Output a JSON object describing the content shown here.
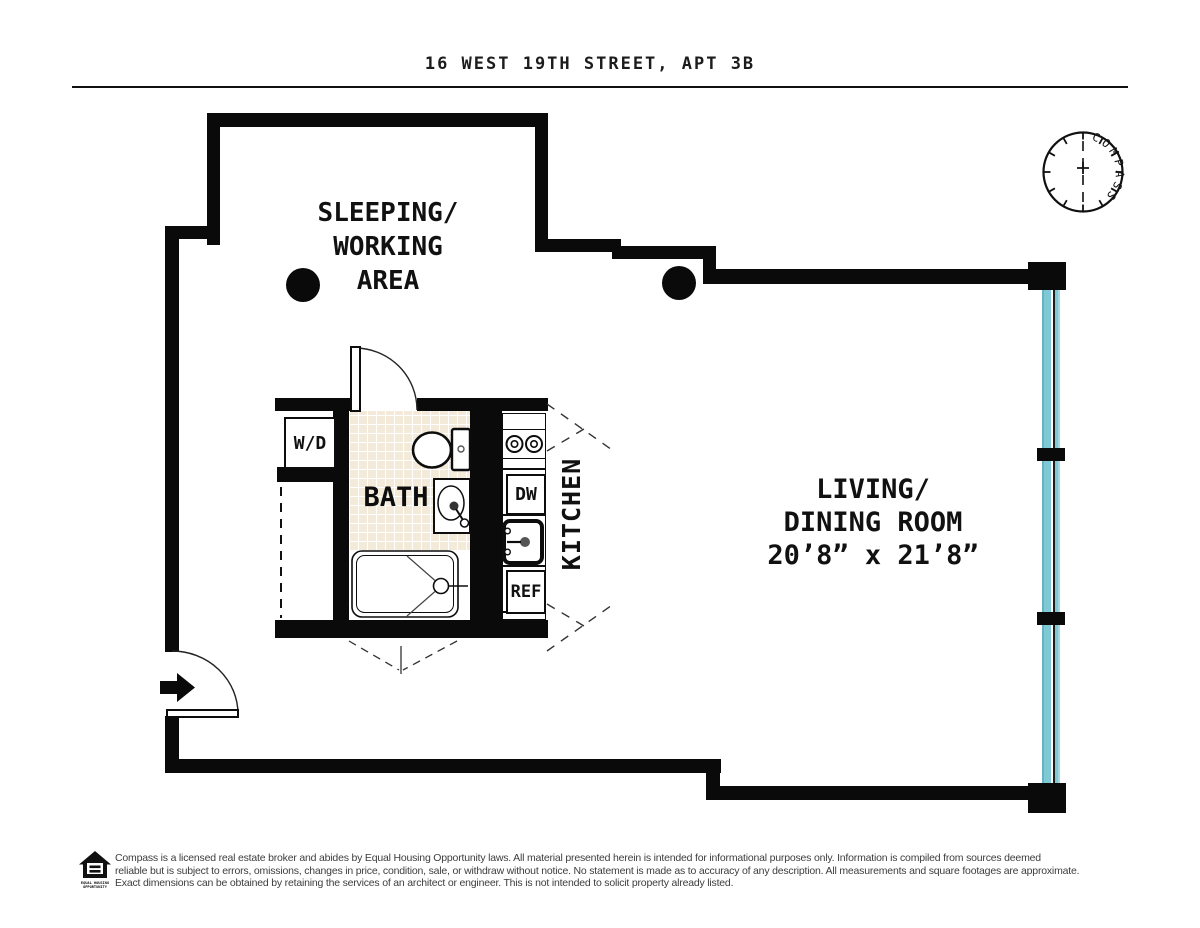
{
  "page": {
    "title": "16 WEST 19TH STREET, APT 3B"
  },
  "compass": {
    "label": "COMPASS"
  },
  "plan": {
    "sleeping_area": {
      "line1": "SLEEPING/",
      "line2": "WORKING",
      "line3": "AREA"
    },
    "living_room": {
      "line1": "LIVING/",
      "line2": "DINING ROOM",
      "line3": "20’8” x 21’8”"
    },
    "bath": {
      "label": "BATH"
    },
    "kitchen": {
      "label": "KITCHEN",
      "dishwasher": "DW",
      "refrigerator": "REF"
    },
    "washer_dryer": {
      "label": "W/D"
    }
  },
  "footer": {
    "logo": {
      "caption_line1": "EQUAL HOUSING",
      "caption_line2": "OPPORTUNITY"
    },
    "disclaimer_line1": "Compass is a licensed real estate broker and abides by Equal Housing Opportunity laws. All material presented herein is intended for informational purposes only. Information is compiled from sources deemed",
    "disclaimer_line2": "reliable but is subject to errors, omissions, changes in price, condition, sale, or withdraw without notice. No statement is made as to accuracy of any description. All measurements and square footages are approximate.",
    "disclaimer_line3": "Exact dimensions can be obtained by retaining the services of an architect or engineer. This is not intended to solicit property already listed."
  },
  "colors": {
    "wall": "#0a0a0a",
    "window_glass": "#7fc8d5",
    "bath_tile": "#f3ead9",
    "text": "#111111",
    "footer_text": "#3d3d3d"
  }
}
